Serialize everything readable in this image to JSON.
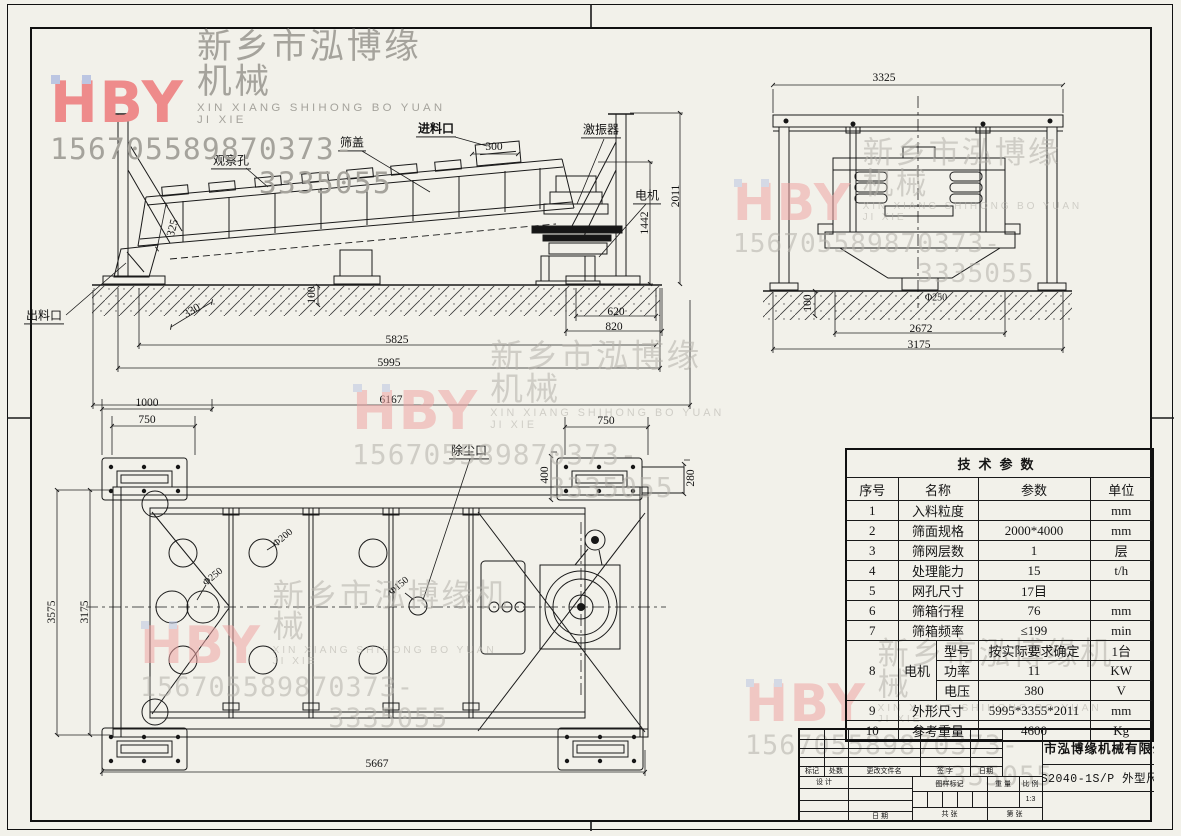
{
  "watermark": {
    "logo": "HBY",
    "company_cn": "新乡市泓博缘机械",
    "company_en": "XIN XIANG SHIHONG BO YUAN JI XIE",
    "phone_mobile": "15670558987",
    "phone_tel": "0373-3335055"
  },
  "side_view": {
    "label_observation_hole": "观察孔",
    "label_screen_cover": "筛盖",
    "label_feed_inlet": "进料口",
    "label_vibrator": "激振器",
    "label_motor": "电机",
    "label_discharge_outlet": "出料口",
    "dim_300": "300",
    "dim_325": "325",
    "dim_330": "330",
    "dim_620": "620",
    "dim_820": "820",
    "dim_5825": "5825",
    "dim_5995": "5995",
    "dim_6167": "6167",
    "dim_100": "100",
    "dim_1442": "1442",
    "dim_2011": "2011"
  },
  "end_view": {
    "dim_3325": "3325",
    "dim_phi250": "Φ250",
    "dim_2672": "2672",
    "dim_3175": "3175",
    "dim_100": "100"
  },
  "top_view": {
    "label_dust_port": "除尘口",
    "dim_1000": "1000",
    "dim_750_left": "750",
    "dim_750_right": "750",
    "dim_400": "400",
    "dim_280": "280",
    "dim_3575": "3575",
    "dim_3175": "3175",
    "dim_5667": "5667",
    "dim_phi250": "Φ250",
    "dim_phi200": "Φ200",
    "dim_phi150": "Φ150"
  },
  "tech_table": {
    "title": "技术参数",
    "col_no": "序号",
    "col_name": "名称",
    "col_value": "参数",
    "col_unit": "单位",
    "r1": {
      "no": "1",
      "name": "入料粒度",
      "value": "",
      "unit": "mm"
    },
    "r2": {
      "no": "2",
      "name": "筛面规格",
      "value": "2000*4000",
      "unit": "mm"
    },
    "r3": {
      "no": "3",
      "name": "筛网层数",
      "value": "1",
      "unit": "层"
    },
    "r4": {
      "no": "4",
      "name": "处理能力",
      "value": "15",
      "unit": "t/h"
    },
    "r5": {
      "no": "5",
      "name": "网孔尺寸",
      "value": "17目",
      "unit": ""
    },
    "r6": {
      "no": "6",
      "name": "筛箱行程",
      "value": "76",
      "unit": "mm"
    },
    "r7": {
      "no": "7",
      "name": "筛箱频率",
      "value": "≤199",
      "unit": "min"
    },
    "r8": {
      "no": "8",
      "name": "电机",
      "s1": {
        "name": "型号",
        "value": "按实际要求确定",
        "unit": "1台"
      },
      "s2": {
        "name": "功率",
        "value": "11",
        "unit": "KW"
      },
      "s3": {
        "name": "电压",
        "value": "380",
        "unit": "V"
      }
    },
    "r9": {
      "no": "9",
      "name": "外形尺寸",
      "value": "5995*3355*2011",
      "unit": "mm"
    },
    "r10": {
      "no": "10",
      "name": "参考重量",
      "value": "4600",
      "unit": "Kg"
    }
  },
  "title_block": {
    "company": "新乡市泓博缘机械有限公司",
    "drawing_title": "FHS2040-1S/P  外型尺寸",
    "lbl_mark": "标记",
    "lbl_count": "处数",
    "lbl_change": "更改文件名",
    "lbl_sign": "签 字",
    "lbl_date": "日期",
    "lbl_design": "设 计",
    "lbl_date2": "日 期",
    "lbl_drawing_mark": "图样标记",
    "lbl_weight": "重 量",
    "lbl_scale": "比 例",
    "scale_value": "1:3",
    "lbl_total": "共  张",
    "lbl_page": "第  张"
  }
}
